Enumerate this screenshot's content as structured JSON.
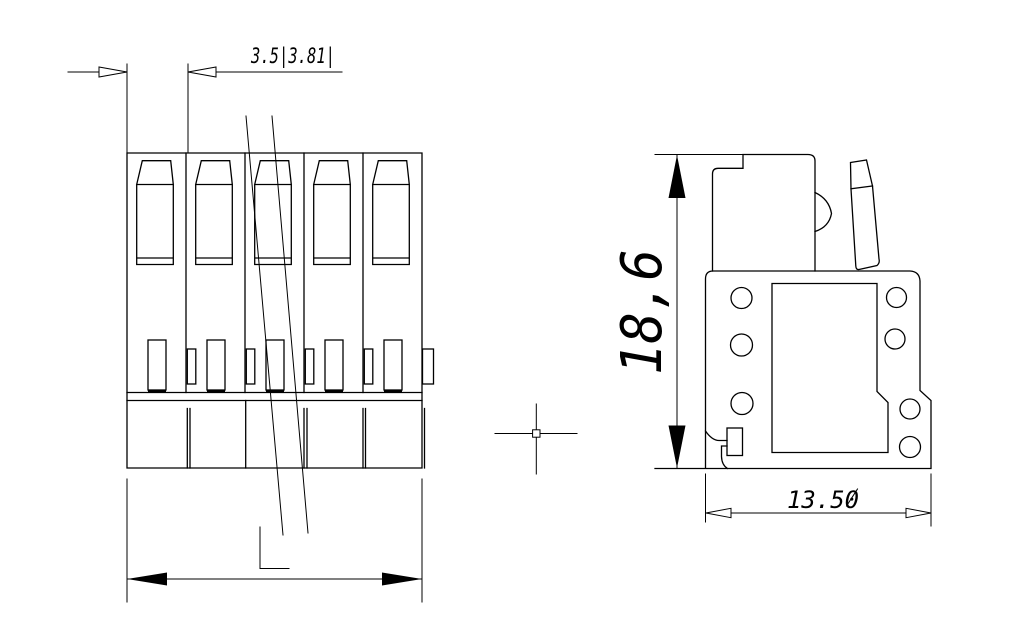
{
  "drawing": {
    "background_color": "#ffffff",
    "line_color": "#000000",
    "pole_count": 5,
    "dimensions": {
      "pitch": "3.5|3.81|",
      "height": "18,6",
      "width": "13.50"
    }
  }
}
